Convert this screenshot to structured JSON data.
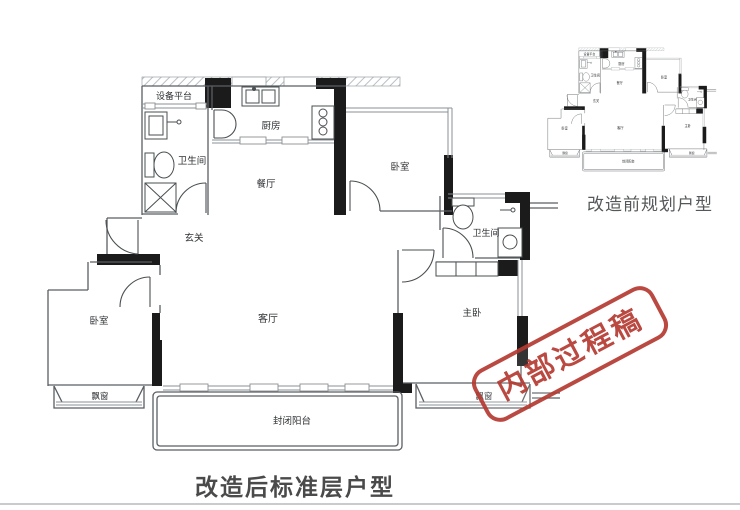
{
  "captions": {
    "main": "改造后标准层户型",
    "small": "改造前规划户型"
  },
  "stamp": {
    "text": "内部过程稿",
    "color": "#b53a31"
  },
  "rooms": {
    "equipment_platform": "设备平台",
    "bathroom_left": "卫生间",
    "kitchen": "厨房",
    "dining_room": "餐厅",
    "foyer": "玄关",
    "bedroom_top": "卧室",
    "bathroom_right": "卫生间",
    "living_room": "客厅",
    "bedroom_left": "卧室",
    "master_bedroom": "主卧",
    "bay_window_left": "飘窗",
    "bay_window_right": "飘窗",
    "balcony": "封闭阳台"
  },
  "colors": {
    "wall_black": "#1b1b1b",
    "wall_line": "#5a5f63",
    "window_line": "#8a9094",
    "stamp_red": "#b53a31",
    "caption_gray": "#4a4a4a"
  }
}
